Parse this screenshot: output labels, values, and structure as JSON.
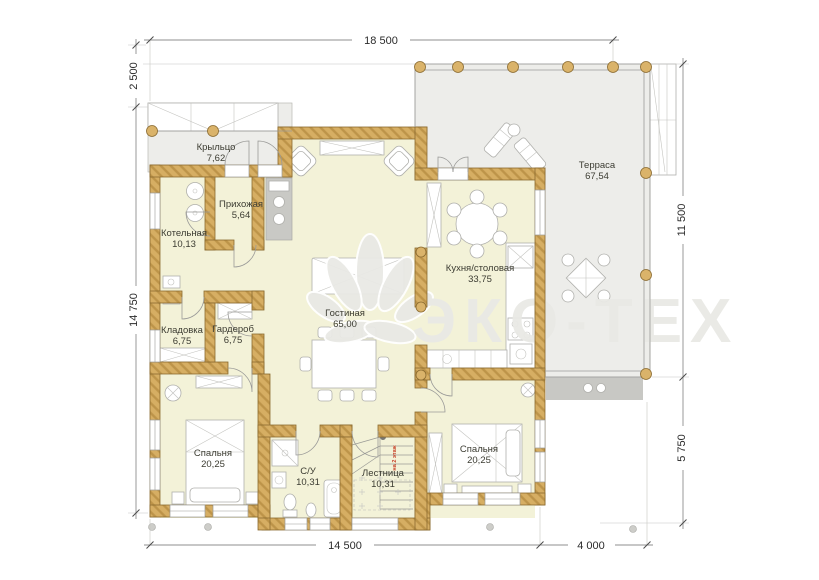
{
  "watermark": {
    "text": "ЭКО-ТЕХ"
  },
  "colors": {
    "walls": "#d6ae63",
    "room_fill": "#f3f2d8",
    "outdoor_fill": "#ededea",
    "steps_fill": "#c8c8c4",
    "note_red": "#c8432a",
    "watermark": "#e9e9e5"
  },
  "dimensions": {
    "top": "18 500",
    "left_upper": "2 500",
    "left_main": "14 750",
    "right_upper": "11 500",
    "right_lower": "5 750",
    "bottom_main": "14 500",
    "bottom_right": "4 000"
  },
  "rooms": [
    {
      "name": "Крыльцо",
      "area": "7,62"
    },
    {
      "name": "Прихожая",
      "area": "5,64"
    },
    {
      "name": "Котельная",
      "area": "10,13"
    },
    {
      "name": "Кладовка",
      "area": "6,75"
    },
    {
      "name": "Гардероб",
      "area": "6,75"
    },
    {
      "name": "Гостиная",
      "area": "65,00"
    },
    {
      "name": "Кухня/столовая",
      "area": "33,75"
    },
    {
      "name": "Терраса",
      "area": "67,54"
    },
    {
      "name": "Спальня",
      "area": "20,25"
    },
    {
      "name": "С/У",
      "area": "10,31"
    },
    {
      "name": "Лестница",
      "area": "10,31"
    },
    {
      "name": "Спальня",
      "area": "20,25"
    }
  ],
  "stairs": {
    "note": "на 2 этаж",
    "steps": [
      "1",
      "2",
      "3",
      "4",
      "5",
      "6",
      "7",
      "8",
      "9"
    ]
  }
}
